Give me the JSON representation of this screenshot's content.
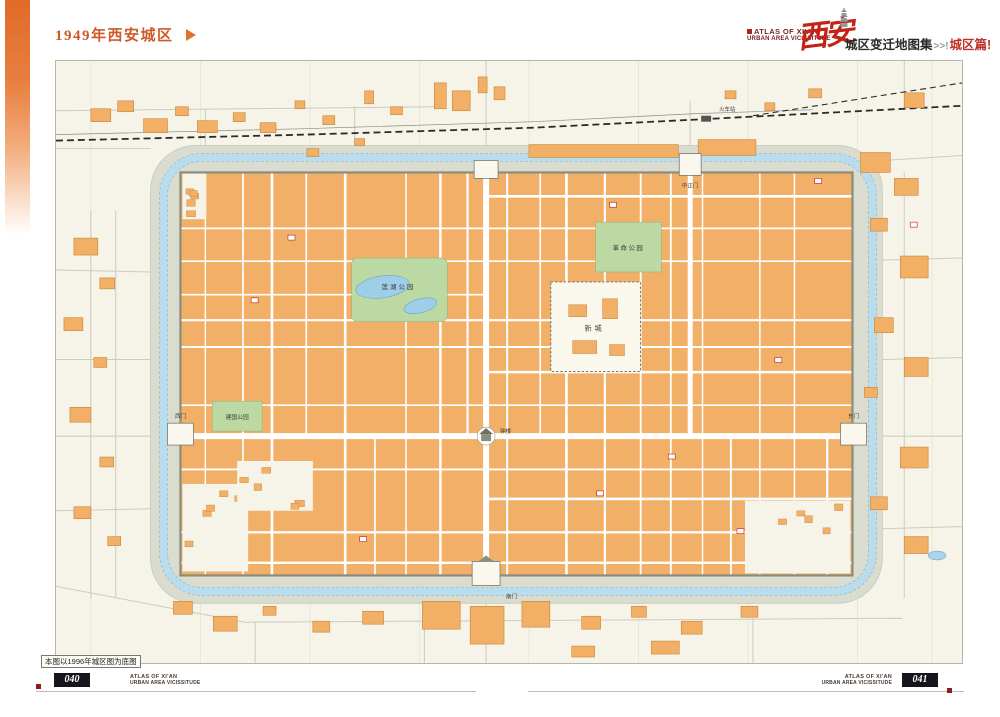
{
  "page": {
    "title": "1949年西安城区",
    "note": "本图以1996年城区图为底图"
  },
  "header": {
    "atlas_line1": "ATLAS OF XI'AN",
    "atlas_line2": "URBAN AREA VICISSITUDE",
    "brand_chars": "西安",
    "series_title": "城区变迁地图集",
    "series_sep": ">>!",
    "series_section": "城区篇!"
  },
  "footer": {
    "left": {
      "page_no": "040",
      "line1": "ATLAS OF XI'AN",
      "line2": "URBAN AREA VICISSITUDE"
    },
    "right": {
      "page_no": "041",
      "line1": "ATLAS OF XI'AN",
      "line2": "URBAN AREA VICISSITUDE"
    }
  },
  "map": {
    "features": [
      {
        "id": "revolution-park",
        "label": "革命公园",
        "type": "park"
      },
      {
        "id": "lianhu-park",
        "label": "莲湖公园",
        "type": "park"
      },
      {
        "id": "jianguo-park",
        "label": "建国公园",
        "type": "park"
      },
      {
        "id": "xincheng",
        "label": "新城",
        "type": "walled-compound"
      },
      {
        "id": "bell-tower",
        "label": "钟楼",
        "type": "landmark"
      },
      {
        "id": "zhongzheng-gate",
        "label": "中正门",
        "type": "city-gate"
      },
      {
        "id": "railway-station",
        "label": "火车站",
        "type": "station"
      },
      {
        "id": "south-gate",
        "label": "南门",
        "type": "city-gate"
      },
      {
        "id": "west-gate",
        "label": "西门",
        "type": "city-gate"
      },
      {
        "id": "east-gate",
        "label": "东门",
        "type": "city-gate"
      }
    ],
    "colors": {
      "accent_orange": "#e06a28",
      "title_orange": "#cf5a28",
      "brand_red": "#c22218",
      "block_orange": "#f1af67",
      "park_green": "#bcd9a3",
      "moat_blue": "#b7ddee",
      "glacis_gray": "#dadcd0",
      "paper_cream": "#f6f4e8",
      "footer_dark": "#15151d"
    }
  }
}
